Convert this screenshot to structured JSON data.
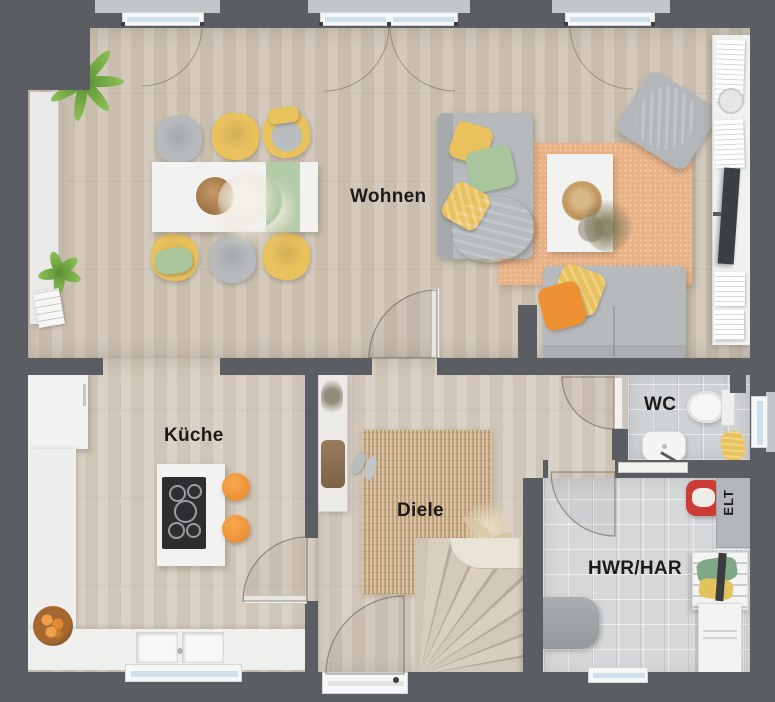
{
  "floorplan": {
    "rooms": {
      "living": {
        "label": "Wohnen"
      },
      "kitchen": {
        "label": "Küche"
      },
      "hall": {
        "label": "Diele"
      },
      "wc": {
        "label": "WC"
      },
      "utility": {
        "label": "HWR/HAR"
      },
      "electrical": {
        "label": "ELT"
      }
    },
    "palette": {
      "wall": "#5a5e63",
      "wood_floor": "#cec4b5",
      "tile_floor": "#cfd2d4",
      "rug_living": "#eab287",
      "rug_hall": "#c8a87e",
      "sofa_gray": "#b6babc",
      "accent_yellow": "#e9c25e",
      "accent_orange": "#ee9132",
      "accent_green": "#a9c59b",
      "accent_red": "#cd3b35",
      "furniture_white": "#f2f2f0",
      "window_glass": "#cfe0ea",
      "label_text": "#1b1b1b"
    }
  }
}
